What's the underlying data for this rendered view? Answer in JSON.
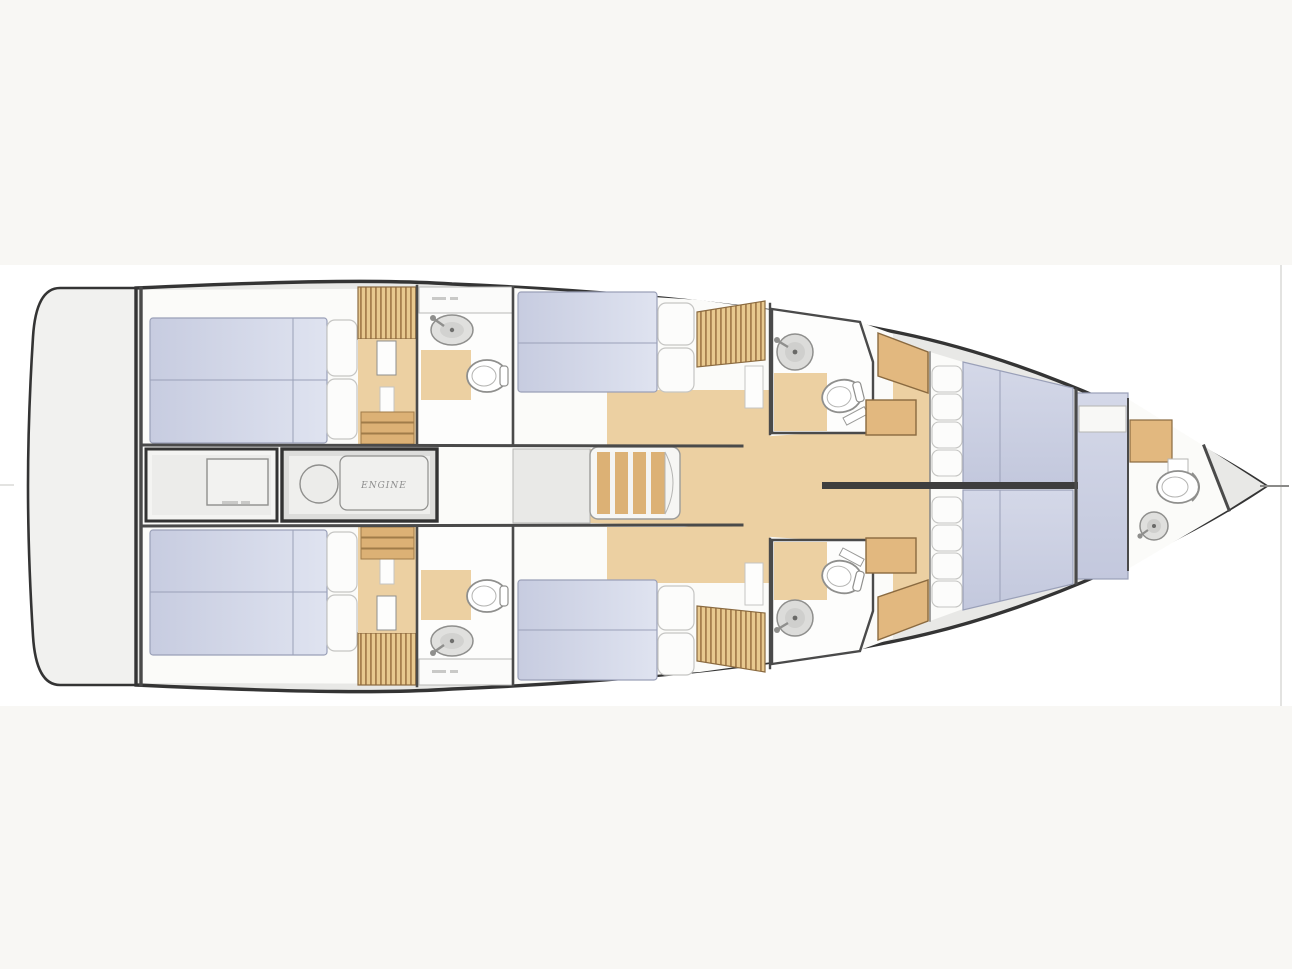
{
  "window": {
    "width": 1292,
    "height": 969
  },
  "labels": {
    "engine_room": "ENGINE"
  },
  "summary": {
    "plan_type": "sailing-yacht interior deck plan, bow pointing right",
    "double_beds": 6,
    "toilets": 5,
    "sinks": 5,
    "stair_sets": 3,
    "engine_room_position": "centerline aft, between the two aft cabins"
  },
  "icons": {
    "toilet": "oval bowl with inner ring",
    "sink": "round basin with faucet stub",
    "wardrobe": "striped hatch block",
    "stairs": "parallel tread bars",
    "engine": "circle plus rounded block"
  },
  "colors": {
    "page_bg": "#f8f7f4",
    "image_bg": "#ffffff",
    "hull_line": "#343434",
    "wall_line": "#4a4a4a",
    "deck": "#e8e8e6",
    "platform": "#f1f1ef",
    "interior": "#fbfbf9",
    "room_white": "#fdfdfc",
    "landing": "#e9e9e7",
    "wood": "#ecd0a2",
    "wood_dark": "#dcb175",
    "wood_edge": "#a07c49",
    "hatch_light": "#e8c98f",
    "hatch_dark": "#a8804e",
    "cabinet": "#e2b87f",
    "cabinet_line": "#8a6a40",
    "mattress_a": "#c7cce0",
    "mattress_b": "#dfe3f0",
    "mattress_line": "#9aa0b8",
    "pillow": "#fcfcfb",
    "pillow_line": "#c5c5c3",
    "fixture_line": "#8f8f8d",
    "fixture_fill": "#e0e0de",
    "engine_text": "#8c8c8c",
    "micro_dash": "#c9c9c7",
    "faint_line": "#e3e3e1"
  }
}
